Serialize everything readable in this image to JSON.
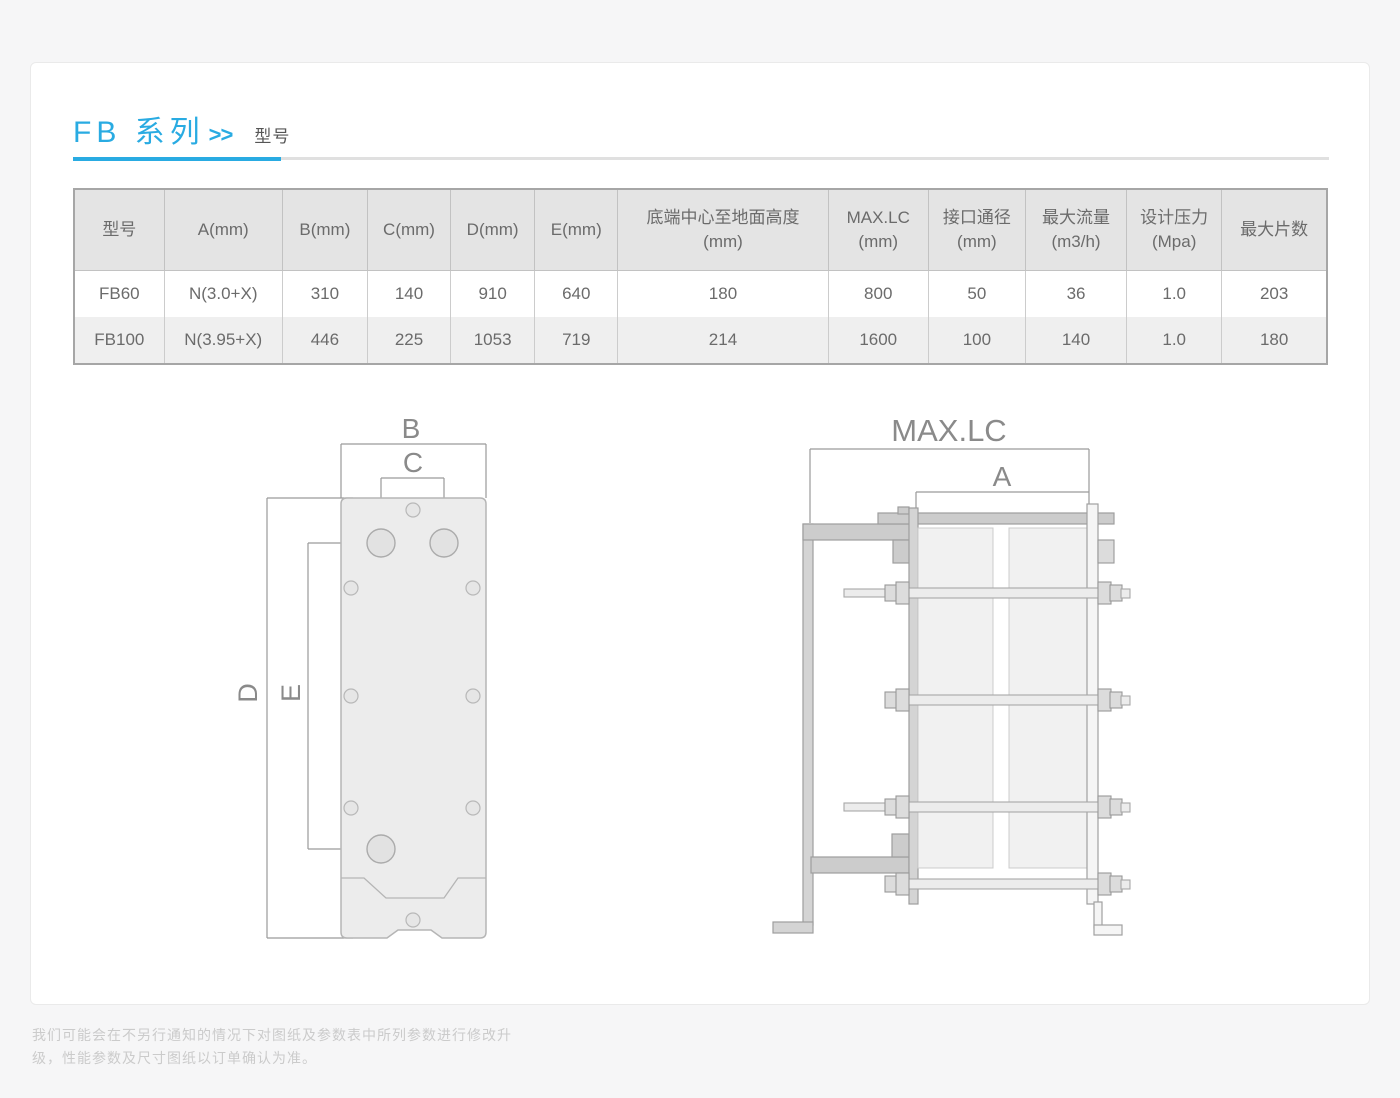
{
  "header": {
    "title": "FB 系列",
    "arrows": ">>",
    "subtitle": "型号"
  },
  "colors": {
    "accent": "#29abe2",
    "table_header_bg": "#e4e4e4",
    "table_alt_row_bg": "#efefef",
    "table_text": "#6b6b6b",
    "diagram_line": "#9a9a9a",
    "footer_text": "#cbcbcb"
  },
  "table": {
    "columns": [
      {
        "line1": "型号",
        "line2": ""
      },
      {
        "line1": "A(mm)",
        "line2": ""
      },
      {
        "line1": "B(mm)",
        "line2": ""
      },
      {
        "line1": "C(mm)",
        "line2": ""
      },
      {
        "line1": "D(mm)",
        "line2": ""
      },
      {
        "line1": "E(mm)",
        "line2": ""
      },
      {
        "line1": "底端中心至地面高度",
        "line2": "(mm)"
      },
      {
        "line1": "MAX.LC",
        "line2": "(mm)"
      },
      {
        "line1": "接口通径",
        "line2": "(mm)"
      },
      {
        "line1": "最大流量",
        "line2": "(m3/h)"
      },
      {
        "line1": "设计压力",
        "line2": "(Mpa)"
      },
      {
        "line1": "最大片数",
        "line2": ""
      }
    ],
    "rows": [
      [
        "FB60",
        "N(3.0+X)",
        "310",
        "140",
        "910",
        "640",
        "180",
        "800",
        "50",
        "36",
        "1.0",
        "203"
      ],
      [
        "FB100",
        "N(3.95+X)",
        "446",
        "225",
        "1053",
        "719",
        "214",
        "1600",
        "100",
        "140",
        "1.0",
        "180"
      ]
    ]
  },
  "diagrams": {
    "front_view": {
      "dim_b": "B",
      "dim_c": "C",
      "dim_d": "D",
      "dim_e": "E"
    },
    "side_view": {
      "dim_max_lc": "MAX.LC",
      "dim_a": "A"
    }
  },
  "footer": {
    "line1": "我们可能会在不另行通知的情况下对图纸及参数表中所列参数进行修改升",
    "line2": "级，性能参数及尺寸图纸以订单确认为准。"
  }
}
